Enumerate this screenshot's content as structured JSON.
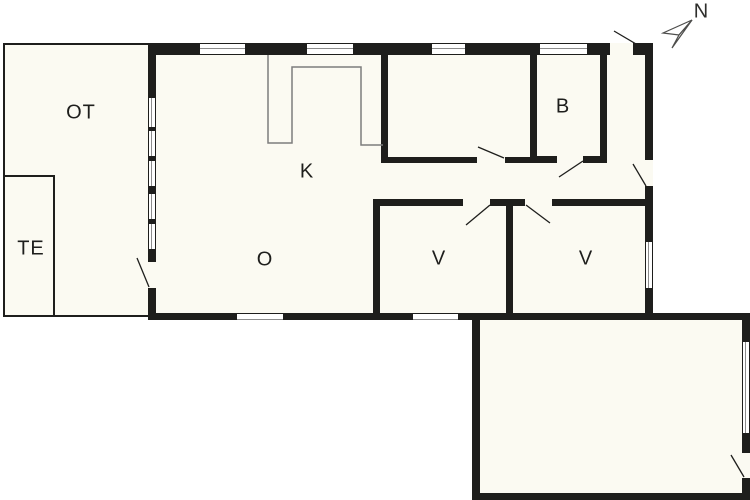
{
  "floorplan": {
    "compass_label": "N",
    "rooms": {
      "terrace": "OT",
      "te": "TE",
      "kitchen": "K",
      "living": "O",
      "bath": "B",
      "bedroom_left": "V",
      "bedroom_right": "V"
    },
    "colors": {
      "wall": "#1e1e1c",
      "room_fill": "#fbfaf2",
      "background": "#ffffff",
      "counter_line": "#7d7d7d",
      "glazing_line": "#8c8c8c"
    }
  }
}
